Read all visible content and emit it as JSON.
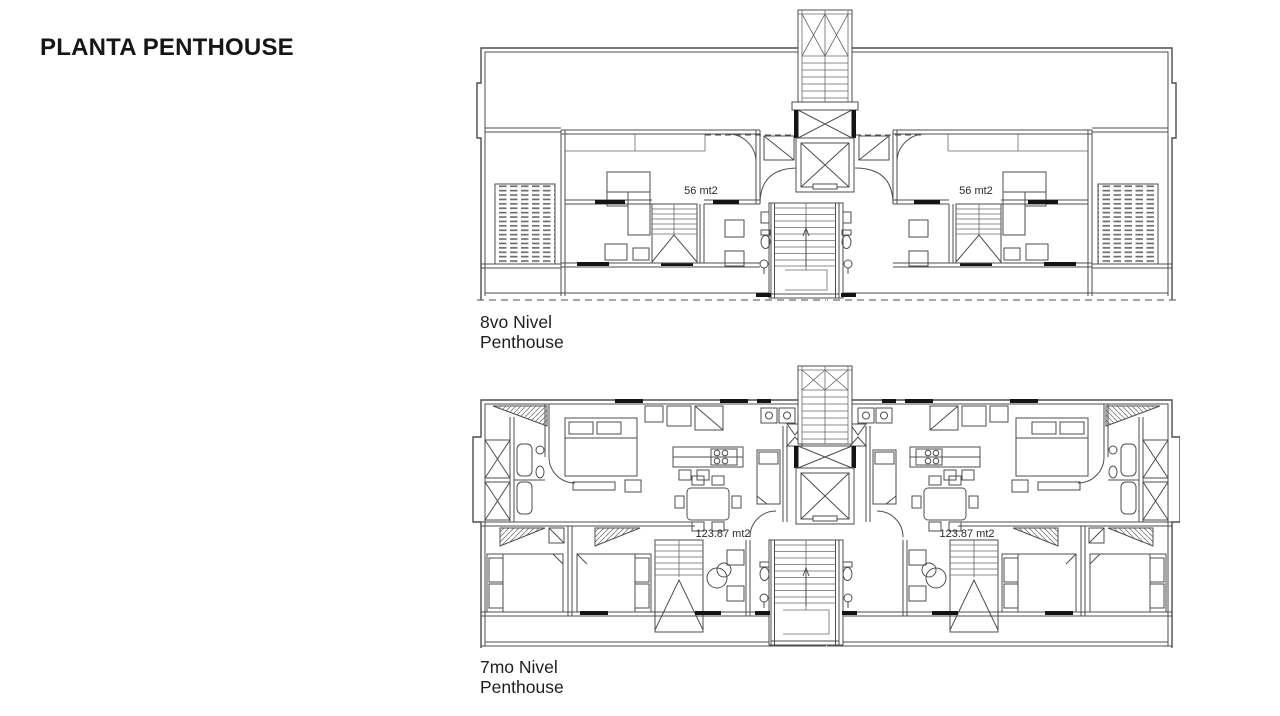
{
  "page": {
    "title": "PLANTA PENTHOUSE"
  },
  "plans": {
    "level8": {
      "name": "8vo Nivel",
      "sub": "Penthouse",
      "left_area": "56 mt2",
      "right_area": "56 mt2"
    },
    "level7": {
      "name": "7mo Nivel",
      "sub": "Penthouse",
      "left_area": "123.87 mt2",
      "right_area": "123.87 mt2"
    }
  },
  "colors": {
    "background": "#ffffff",
    "line": "#4d4d4d",
    "wall_dark": "#141414",
    "text": "#1e1e1e"
  }
}
